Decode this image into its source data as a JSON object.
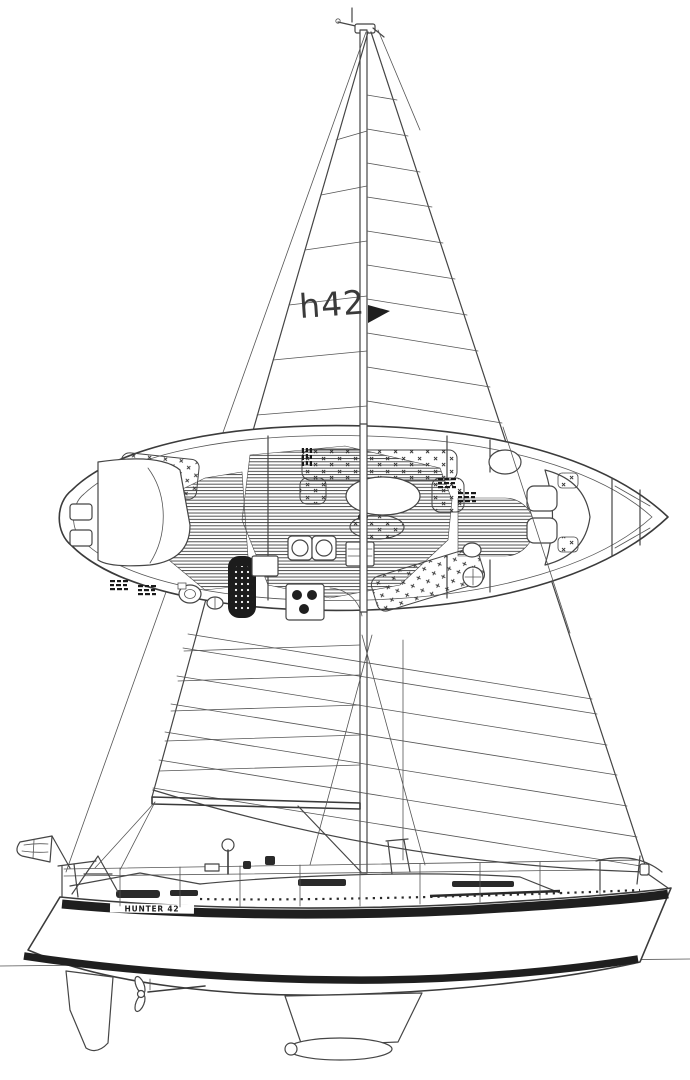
{
  "drawing": {
    "sail_logo": "h42",
    "hull_name": "HUNTER 42",
    "colors": {
      "ink": "#454545",
      "heavy_ink": "#1f1f1f",
      "paper": "#ffffff"
    }
  }
}
